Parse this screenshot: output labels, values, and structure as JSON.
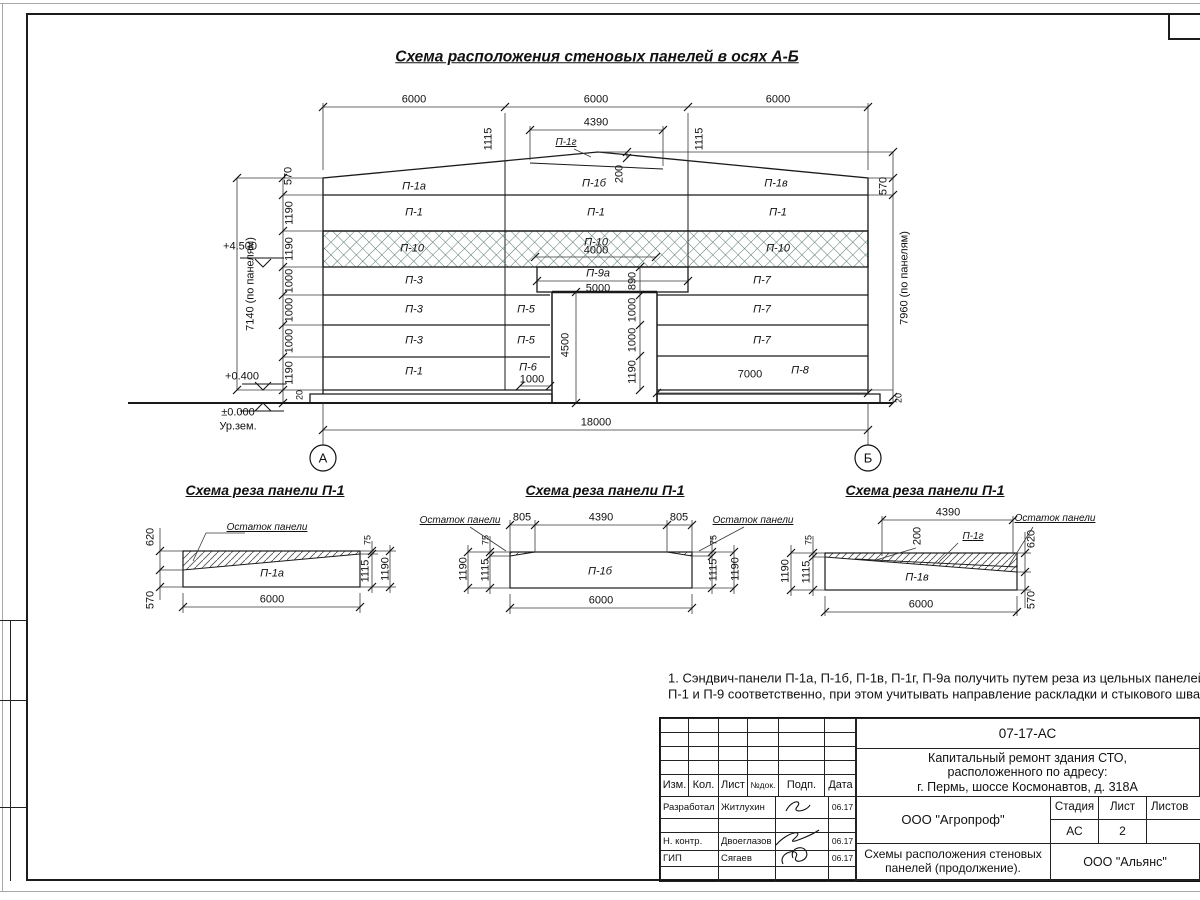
{
  "sheet": {
    "main_title": "Схема расположения стеновых панелей в осях А-Б",
    "note_line1": "1. Сэндвич-панели П-1а, П-1б, П-1в, П-1г, П-9а получить путем реза из цельных панелей",
    "note_line2": "П-1 и П-9 соответственно, при этом учитывать направление раскладки и стыкового шва."
  },
  "elevation": {
    "axis_a": "А",
    "axis_b": "Б",
    "dims": {
      "d6000": "6000",
      "d4390": "4390",
      "d1115": "1115",
      "d570": "570",
      "d200": "200",
      "d1190": "1190",
      "d1000": "1000",
      "d20": "20",
      "d7140": "7140 (по панелям)",
      "d7960": "7960 (по панелям)",
      "d4500": "4500",
      "d890": "890",
      "d5000": "5000",
      "d4000": "4000",
      "d7000": "7000",
      "d18000": "18000"
    },
    "levels": {
      "top": "+4.500",
      "mid": "+0.400",
      "zero": "±0.000",
      "ground": "Ур.зем."
    },
    "panels": {
      "p1a": "П-1а",
      "p1b": "П-1б",
      "p1v": "П-1в",
      "p1g": "П-1г",
      "p1": "П-1",
      "p3": "П-3",
      "p5": "П-5",
      "p6": "П-6",
      "p7": "П-7",
      "p8": "П-8",
      "p9a": "П-9а",
      "p10": "П-10"
    },
    "hatch_color": "#55796b"
  },
  "details": {
    "title": "Схема реза панели П-1",
    "remnant": "Остаток панели",
    "dims": {
      "d620": "620",
      "d570": "570",
      "d75": "75",
      "d1115": "1115",
      "d1190": "1190",
      "d6000": "6000",
      "d805": "805",
      "d4390": "4390",
      "d200": "200"
    },
    "panels": {
      "p1a": "П-1а",
      "p1b": "П-1б",
      "p1v": "П-1в",
      "p1g": "П-1г"
    }
  },
  "titleblock": {
    "doc_number": "07-17-АС",
    "project_line1": "Капитальный ремонт здания СТО,",
    "project_line2": "расположенного по адресу:",
    "project_line3": "г. Пермь, шоссе Космонавтов, д. 318А",
    "cols": {
      "izm": "Изм.",
      "kol": "Кол.",
      "list": "Лист",
      "ndok": "№док.",
      "podp": "Подп.",
      "data": "Дата"
    },
    "rows": [
      {
        "role": "Разработал",
        "name": "Житлухин",
        "date": "06.17"
      },
      {
        "role": "Н. контр.",
        "name": "Двоеглазов",
        "date": "06.17"
      },
      {
        "role": "ГИП",
        "name": "Сягаев",
        "date": "06.17"
      }
    ],
    "org": "ООО \"Агропроф\"",
    "stage_label": "Стадия",
    "sheet_label": "Лист",
    "sheets_label": "Листов",
    "stage": "АС",
    "sheet_num": "2",
    "sheets_num": "",
    "doc_title_line1": "Схемы расположения стеновых",
    "doc_title_line2": "панелей (продолжение).",
    "org2": "ООО \"Альянс\""
  }
}
